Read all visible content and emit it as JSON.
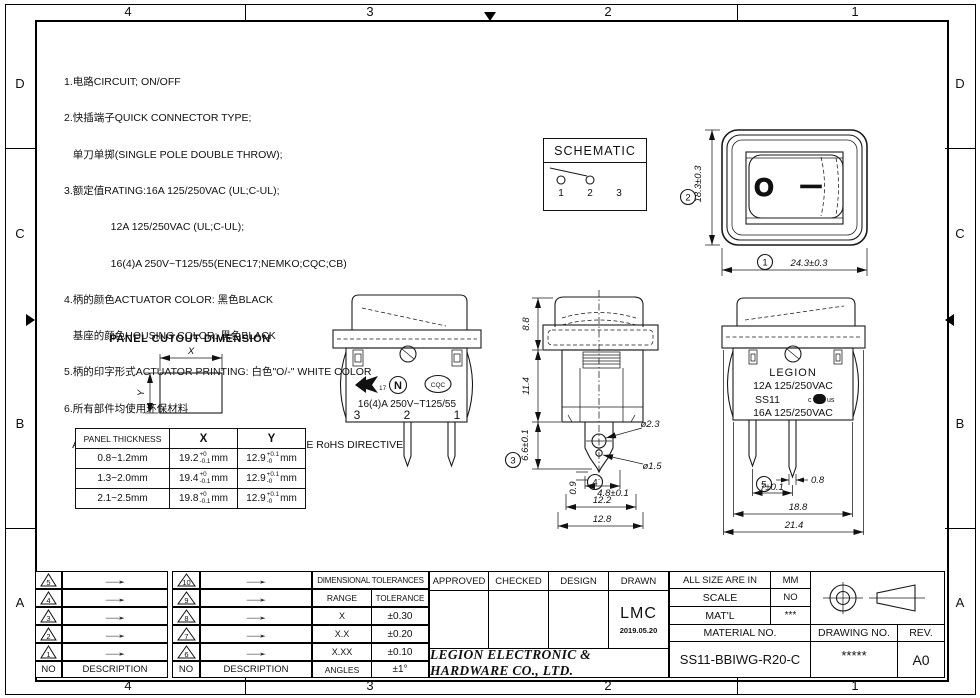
{
  "sheet": {
    "zones_h": [
      "4",
      "3",
      "2",
      "1"
    ],
    "zones_v": [
      "D",
      "C",
      "B",
      "A"
    ]
  },
  "notes": {
    "lines": [
      "1.电路CIRCUIT; ON/OFF",
      "2.快插端子QUICK CONNECTOR TYPE;",
      "   单刀单掷(SINGLE POLE DOUBLE THROW);",
      "3.额定值RATING:16A 125/250VAC (UL;C-UL);",
      "                12A 125/250VAC (UL;C-UL);",
      "                16(4)A 250V~T125/55(ENEC17;NEMKO;CQC;CB)",
      "4.柄的颜色ACTUATOR COLOR: 黑色BLACK",
      "   基座的颜色HOUSING COLOR: 黑色BLACK",
      "5.柄的印字形式ACTUATOR PRINTING: 白色\"O/-\" WHITE COLOR",
      "6.所有部件均使用环保材料",
      "   ALL MATERIALS USE IN CONFORMIY  WITH THE RoHS DIRECTIVE"
    ]
  },
  "schematic": {
    "title": "SCHEMATIC",
    "t1": "1",
    "t2": "2",
    "t3": "3"
  },
  "front_view": {
    "balloon1": "1",
    "balloon2": "2",
    "dim_width": "24.3±0.3",
    "dim_height": "18.3±0.3",
    "mark_off": "O",
    "mark_on": "—"
  },
  "panel_cutout": {
    "title": "PANEL CUTOUT DIMENSION",
    "x_label": "X",
    "y_label": "Y",
    "table": {
      "headers": [
        "PANEL THICKNESS",
        "X",
        "Y"
      ],
      "unit": "mm",
      "rows": [
        {
          "thickness": "0.8~1.2mm",
          "x": "19.2",
          "x_sup": "+0",
          "x_sub": "-0.1",
          "y": "12.9",
          "y_sup": "+0.1",
          "y_sub": "-0"
        },
        {
          "thickness": "1.3~2.0mm",
          "x": "19.4",
          "x_sup": "+0",
          "x_sub": "-0.1",
          "y": "12.9",
          "y_sup": "+0.1",
          "y_sub": "-0"
        },
        {
          "thickness": "2.1~2.5mm",
          "x": "19.8",
          "x_sup": "+0",
          "x_sub": "-0.1",
          "y": "12.9",
          "y_sup": "+0.1",
          "y_sub": "-0"
        }
      ]
    }
  },
  "view_marks": {
    "rating": "16(4)A 250V~T125/55",
    "t3": "3",
    "t2": "2",
    "t1": "1",
    "enec_no": "17",
    "nemko": "N",
    "cqc": "CQC"
  },
  "view_side": {
    "dim_rocker": "8.8",
    "dim_body": "11.4",
    "dim_term": "6.6±0.1",
    "balloon3": "3",
    "balloon4": "4",
    "dia_hole": "ø2.3",
    "dia_tip": "ø1.5",
    "dim_thick": "0.9",
    "dim_term_w": "4.8±0.1",
    "dim_w1": "12.2",
    "dim_w2": "12.8"
  },
  "view_back": {
    "brand": "LEGION",
    "line1": "12A 125/250VAC",
    "line2": "SS11",
    "line3": "16A 125/250VAC",
    "ul_c": "c",
    "ul_core": "UL",
    "ul_us": "us",
    "balloon5": "5",
    "dim_pin": "0.8",
    "dim_pitch": "7±0.1",
    "dim_w1": "18.8",
    "dim_w2": "21.4"
  },
  "title_block": {
    "revisions": {
      "no_label": "NO",
      "desc_label": "DESCRIPTION",
      "arrow": "→",
      "left": [
        "5",
        "4",
        "3",
        "2",
        "1"
      ],
      "right": [
        "10",
        "9",
        "8",
        "7",
        "6"
      ]
    },
    "tolerances": {
      "title": "DIMENSIONAL TOLERANCES",
      "range_label": "RANGE",
      "tol_label": "TOLERANCE",
      "rows": [
        {
          "range": "X",
          "tol": "±0.30"
        },
        {
          "range": "X.X",
          "tol": "±0.20"
        },
        {
          "range": "X.XX",
          "tol": "±0.10"
        },
        {
          "range": "ANGLES",
          "tol": "±1°"
        }
      ]
    },
    "signoff": {
      "approved": "APPROVED",
      "checked": "CHECKED",
      "design": "DESIGN",
      "drawn": "DRAWN",
      "drawn_by": "LMC",
      "drawn_date": "2019.05.20",
      "company": "LEGION ELECTRONIC & HARDWARE CO., LTD."
    },
    "info": {
      "all_size_label": "ALL SIZE ARE IN",
      "all_size_value": "MM",
      "scale_label": "SCALE",
      "scale_value": "NO",
      "matl_label": "MAT'L",
      "matl_value": "***",
      "material_no_label": "MATERIAL NO.",
      "material_no_value": "SS11-BBIWG-R20-C",
      "drawing_no_label": "DRAWING NO.",
      "drawing_no_value": "*****",
      "rev_label": "REV.",
      "rev_value": "A0"
    }
  }
}
